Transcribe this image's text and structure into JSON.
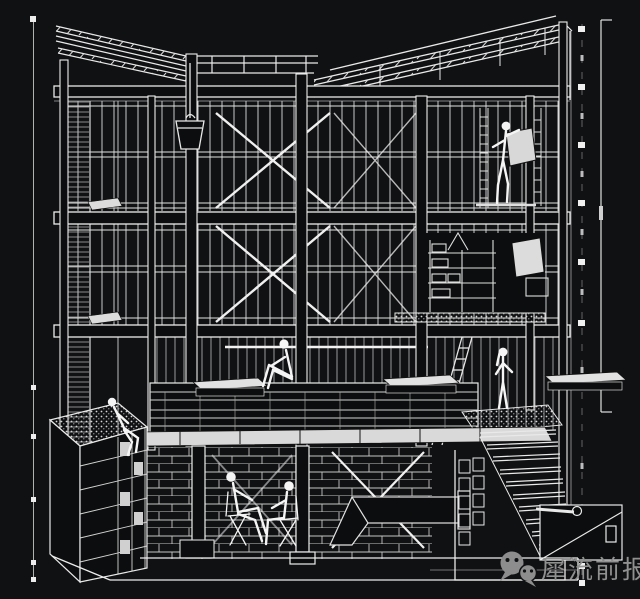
{
  "palette": {
    "background": "#101113",
    "line": "#e9e9e9",
    "faint_line": "#9a9a9a",
    "panel_fill": "#d9d9d9",
    "watermark_gray": "#8f8f8f"
  },
  "watermark": {
    "account": "犀流前报",
    "icon": "wechat-icon",
    "color": "#909090"
  },
  "drawing": {
    "type": "architectural-cutaway-section-perspective",
    "style": "white line art on black",
    "levels": [
      "mono-pitch roof with battened rafters",
      "third floor with cross-braced bays and glazing",
      "second floor with cross-braced bays, shelf scaffold and panels",
      "first floor deck with benches and guardrail",
      "basement with masonry walls, props, duct and stair"
    ],
    "features": [
      "hanging-bucket",
      "leaning-ladder",
      "right-staircase",
      "gravel-planter-box",
      "stippled-platform",
      "dimension-tick-columns"
    ],
    "figures": [
      "figure-sitting-on-deck",
      "figure-sitting-on-planter",
      "figure-seated-basement-left",
      "figure-seated-basement-right",
      "figure-standing-at-stair",
      "figure-on-upper-scaffold"
    ]
  }
}
